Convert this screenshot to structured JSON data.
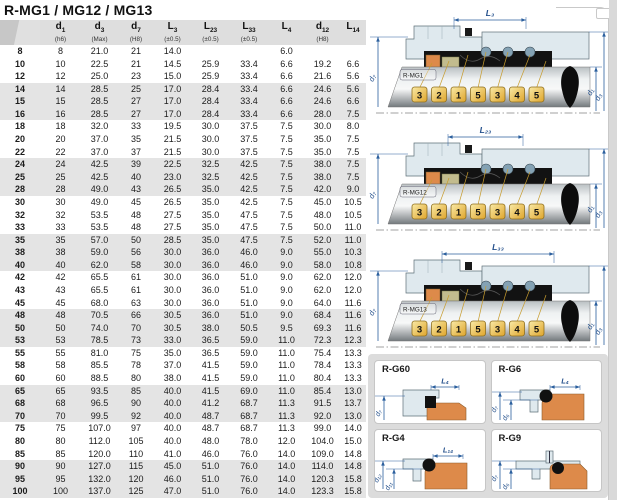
{
  "page": {
    "title": "R-MG1 / MG12 / MG13"
  },
  "colors": {
    "dimension_blue": "#2b5f9e",
    "dim_label_blue": "#24508c",
    "balloon_gold_light": "#f9eaa6",
    "balloon_gold_dark": "#dfa52c",
    "balloon_border": "#8f6f1f",
    "leader_yellow": "#c79c2e",
    "seat_orange": "#dd8a4a",
    "part_tan": "#c2bc8e",
    "spring_blue": "#84a2b4",
    "housing_blue": "#dfe9ee",
    "housing_stroke": "#5f7078",
    "band_gray": "#e4e4e4",
    "header_gray": "#dedede",
    "rubber_black": "#121212"
  },
  "table": {
    "col_headers": [
      {
        "letter": "",
        "sub": "",
        "note": ""
      },
      {
        "letter": "d",
        "sub": "1",
        "note": "(h6)"
      },
      {
        "letter": "d",
        "sub": "3",
        "note": "(Max)"
      },
      {
        "letter": "d",
        "sub": "7",
        "note": "(H8)"
      },
      {
        "letter": "L",
        "sub": "3",
        "note": "(±0.5)"
      },
      {
        "letter": "L",
        "sub": "23",
        "note": "(±0.5)"
      },
      {
        "letter": "L",
        "sub": "33",
        "note": "(±0.5)"
      },
      {
        "letter": "L",
        "sub": "4",
        "note": ""
      },
      {
        "letter": "d",
        "sub": "12",
        "note": "(H8)"
      },
      {
        "letter": "L",
        "sub": "14",
        "note": ""
      }
    ],
    "rows": [
      [
        "8",
        "8",
        "21.0",
        "21",
        "14.0",
        "",
        "",
        "6.0",
        "",
        ""
      ],
      [
        "10",
        "10",
        "22.5",
        "21",
        "14.5",
        "25.9",
        "33.4",
        "6.6",
        "19.2",
        "6.6"
      ],
      [
        "12",
        "12",
        "25.0",
        "23",
        "15.0",
        "25.9",
        "33.4",
        "6.6",
        "21.6",
        "5.6"
      ],
      [
        "14",
        "14",
        "28.5",
        "25",
        "17.0",
        "28.4",
        "33.4",
        "6.6",
        "24.6",
        "5.6"
      ],
      [
        "15",
        "15",
        "28.5",
        "27",
        "17.0",
        "28.4",
        "33.4",
        "6.6",
        "24.6",
        "6.6"
      ],
      [
        "16",
        "16",
        "28.5",
        "27",
        "17.0",
        "28.4",
        "33.4",
        "6.6",
        "28.0",
        "7.5"
      ],
      [
        "18",
        "18",
        "32.0",
        "33",
        "19.5",
        "30.0",
        "37.5",
        "7.5",
        "30.0",
        "8.0"
      ],
      [
        "20",
        "20",
        "37.0",
        "35",
        "21.5",
        "30.0",
        "37.5",
        "7.5",
        "35.0",
        "7.5"
      ],
      [
        "22",
        "22",
        "37.0",
        "37",
        "21.5",
        "30.0",
        "37.5",
        "7.5",
        "35.0",
        "7.5"
      ],
      [
        "24",
        "24",
        "42.5",
        "39",
        "22.5",
        "32.5",
        "42.5",
        "7.5",
        "38.0",
        "7.5"
      ],
      [
        "25",
        "25",
        "42.5",
        "40",
        "23.0",
        "32.5",
        "42.5",
        "7.5",
        "38.0",
        "7.5"
      ],
      [
        "28",
        "28",
        "49.0",
        "43",
        "26.5",
        "35.0",
        "42.5",
        "7.5",
        "42.0",
        "9.0"
      ],
      [
        "30",
        "30",
        "49.0",
        "45",
        "26.5",
        "35.0",
        "42.5",
        "7.5",
        "45.0",
        "10.5"
      ],
      [
        "32",
        "32",
        "53.5",
        "48",
        "27.5",
        "35.0",
        "47.5",
        "7.5",
        "48.0",
        "10.5"
      ],
      [
        "33",
        "33",
        "53.5",
        "48",
        "27.5",
        "35.0",
        "47.5",
        "7.5",
        "50.0",
        "11.0"
      ],
      [
        "35",
        "35",
        "57.0",
        "50",
        "28.5",
        "35.0",
        "47.5",
        "7.5",
        "52.0",
        "11.0"
      ],
      [
        "38",
        "38",
        "59.0",
        "56",
        "30.0",
        "36.0",
        "46.0",
        "9.0",
        "55.0",
        "10.3"
      ],
      [
        "40",
        "40",
        "62.0",
        "58",
        "30.0",
        "36.0",
        "46.0",
        "9.0",
        "58.0",
        "10.8"
      ],
      [
        "42",
        "42",
        "65.5",
        "61",
        "30.0",
        "36.0",
        "51.0",
        "9.0",
        "62.0",
        "12.0"
      ],
      [
        "43",
        "43",
        "65.5",
        "61",
        "30.0",
        "36.0",
        "51.0",
        "9.0",
        "62.0",
        "12.0"
      ],
      [
        "45",
        "45",
        "68.0",
        "63",
        "30.0",
        "36.0",
        "51.0",
        "9.0",
        "64.0",
        "11.6"
      ],
      [
        "48",
        "48",
        "70.5",
        "66",
        "30.5",
        "36.0",
        "51.0",
        "9.0",
        "68.4",
        "11.6"
      ],
      [
        "50",
        "50",
        "74.0",
        "70",
        "30.5",
        "38.0",
        "50.5",
        "9.5",
        "69.3",
        "11.6"
      ],
      [
        "53",
        "53",
        "78.5",
        "73",
        "33.0",
        "36.5",
        "59.0",
        "11.0",
        "72.3",
        "12.3"
      ],
      [
        "55",
        "55",
        "81.0",
        "75",
        "35.0",
        "36.5",
        "59.0",
        "11.0",
        "75.4",
        "13.3"
      ],
      [
        "58",
        "58",
        "85.5",
        "78",
        "37.0",
        "41.5",
        "59.0",
        "11.0",
        "78.4",
        "13.3"
      ],
      [
        "60",
        "60",
        "88.5",
        "80",
        "38.0",
        "41.5",
        "59.0",
        "11.0",
        "80.4",
        "13.3"
      ],
      [
        "65",
        "65",
        "93.5",
        "85",
        "40.0",
        "41.5",
        "69.0",
        "11.0",
        "85.4",
        "13.0"
      ],
      [
        "68",
        "68",
        "96.5",
        "90",
        "40.0",
        "41.2",
        "68.7",
        "11.3",
        "91.5",
        "13.7"
      ],
      [
        "70",
        "70",
        "99.5",
        "92",
        "40.0",
        "48.7",
        "68.7",
        "11.3",
        "92.0",
        "13.0"
      ],
      [
        "75",
        "75",
        "107.0",
        "97",
        "40.0",
        "48.7",
        "68.7",
        "11.3",
        "99.0",
        "14.0"
      ],
      [
        "80",
        "80",
        "112.0",
        "105",
        "40.0",
        "48.0",
        "78.0",
        "12.0",
        "104.0",
        "15.0"
      ],
      [
        "85",
        "85",
        "120.0",
        "110",
        "41.0",
        "46.0",
        "76.0",
        "14.0",
        "109.0",
        "14.8"
      ],
      [
        "90",
        "90",
        "127.0",
        "115",
        "45.0",
        "51.0",
        "76.0",
        "14.0",
        "114.0",
        "14.8"
      ],
      [
        "95",
        "95",
        "132.0",
        "120",
        "46.0",
        "51.0",
        "76.0",
        "14.0",
        "120.3",
        "15.8"
      ],
      [
        "100",
        "100",
        "137.0",
        "125",
        "47.0",
        "51.0",
        "76.0",
        "14.0",
        "123.3",
        "15.8"
      ]
    ]
  },
  "diagrams": {
    "mg1": {
      "label": "R-MG1",
      "dim_top": "L₃",
      "dim_left": "d₇",
      "dim_inner": "d₁",
      "dim_outer": "d₃",
      "balloons": [
        "3",
        "2",
        "1",
        "5",
        "3",
        "4",
        "5"
      ]
    },
    "mg12": {
      "label": "R-MG12",
      "dim_top": "L₂₃",
      "dim_left": "d₇",
      "dim_inner": "d₁",
      "dim_outer": "d₃",
      "balloons": [
        "3",
        "2",
        "1",
        "5",
        "3",
        "4",
        "5"
      ]
    },
    "mg13": {
      "label": "R-MG13",
      "dim_top": "L₃₃",
      "dim_left": "d₇",
      "dim_inner": "d₁",
      "dim_outer": "d₃",
      "balloons": [
        "3",
        "2",
        "1",
        "5",
        "3",
        "4",
        "5"
      ]
    },
    "g60": {
      "label": "R-G60",
      "dim_top": "L₄",
      "dim_a": "d₇"
    },
    "g6": {
      "label": "R-G6",
      "dim_top": "L₄",
      "dim_a": "d₇",
      "dim_b": "d₆"
    },
    "g4": {
      "label": "R-G4",
      "dim_top": "L₁₄",
      "dim_a": "d₁₂",
      "dim_b": "d₁₁"
    },
    "g9": {
      "label": "R-G9",
      "dim_a": "d₇",
      "dim_b": "d₆"
    }
  }
}
